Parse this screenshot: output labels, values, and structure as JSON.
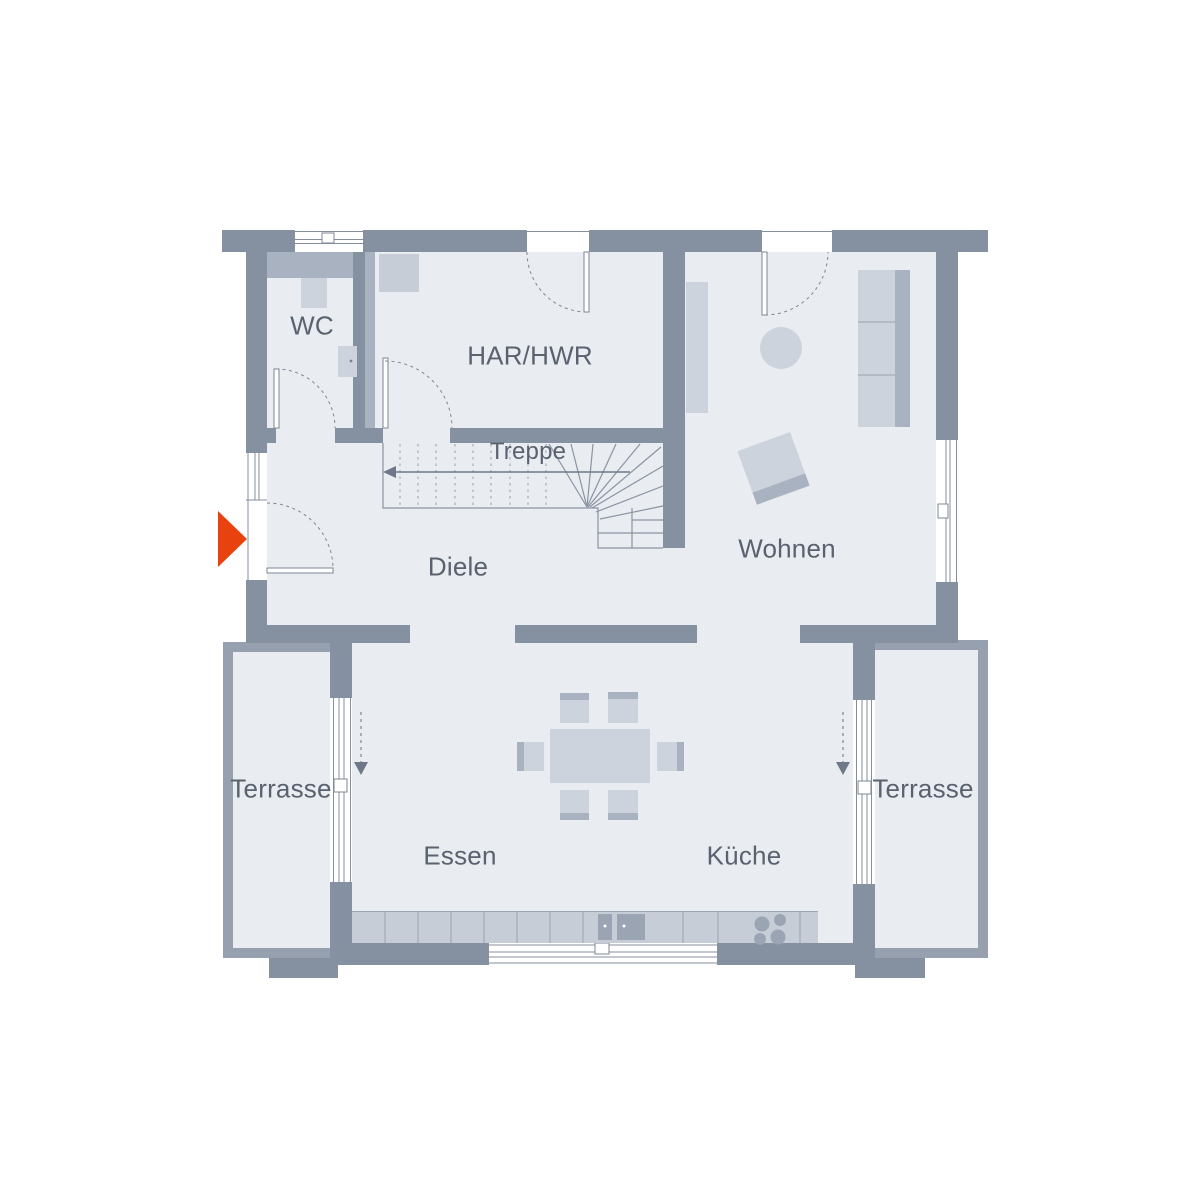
{
  "floorplan": {
    "labels": {
      "wc": "WC",
      "har_hwr": "HAR/HWR",
      "treppe": "Treppe",
      "diele": "Diele",
      "wohnen": "Wohnen",
      "terrasse_left": "Terrasse",
      "terrasse_right": "Terrasse",
      "essen": "Essen",
      "kueche": "Küche"
    },
    "icons": {
      "entrance": "entrance-arrow",
      "stairs_direction": "arrow-left-up-stairs",
      "sliding_door_left": "slide-direction-down-arrow",
      "sliding_door_right": "slide-direction-down-arrow"
    },
    "colors": {
      "wall": "#8591a1",
      "wall_light": "#97a0af",
      "floor": "#e9ecf1",
      "furniture_light": "#cdd3dc",
      "furniture_mid": "#a9b2c0",
      "counter": "#c7cdd7",
      "fixture": "#9aa4b2",
      "text": "#5a6270",
      "accent": "#e8430e",
      "background": "#ffffff"
    }
  }
}
